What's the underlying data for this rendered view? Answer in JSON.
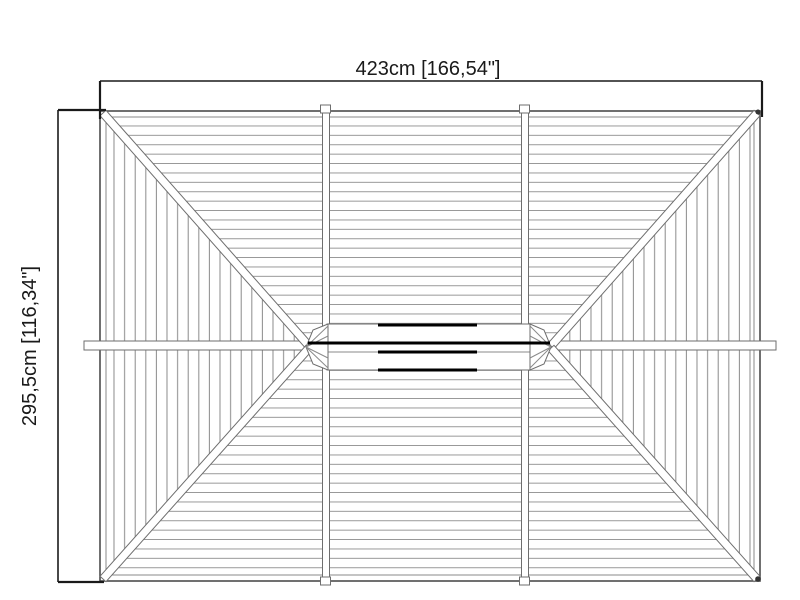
{
  "drawing": {
    "description": "Hip roof plan, top view"
  },
  "dimensions": {
    "width": {
      "label": "423cm [166,54\"]",
      "cm": "423",
      "inches": "166,54"
    },
    "height": {
      "label": "295,5cm [116,34\"]",
      "cm": "295,5",
      "inches": "116,34"
    }
  },
  "colors": {
    "background": "#ffffff",
    "board_line": "#8a8a8a",
    "outline": "#4d4d4d",
    "beam_edge": "#6e6e6e",
    "dimension_text": "#1a1a1a",
    "ridge_accent": "#000000"
  }
}
